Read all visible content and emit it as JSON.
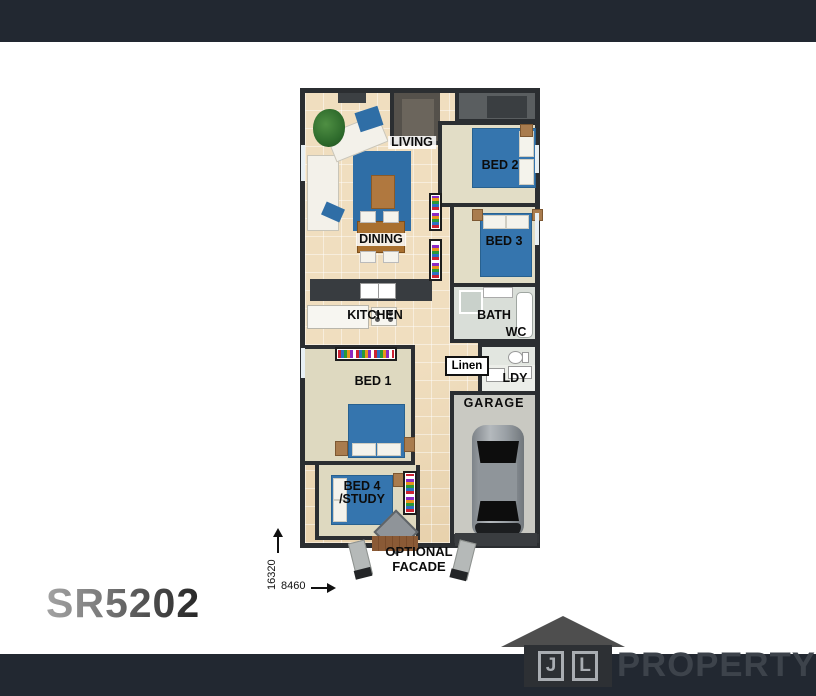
{
  "title": {
    "plan_code": "SR5202"
  },
  "plan": {
    "labels": {
      "living": "LIVING",
      "bed2": "BED 2",
      "bed3": "BED 3",
      "dining": "DINING",
      "kitchen": "KITCHEN",
      "bath": "BATH",
      "wc": "WC",
      "linen": "Linen",
      "ldy": "LDY",
      "bed1": "BED 1",
      "garage": "GARAGE",
      "bed4_line1": "BED 4",
      "bed4_line2": "/STUDY",
      "facade_line1": "OPTIONAL",
      "facade_line2": "FACADE"
    },
    "dimensions": {
      "vertical": "16320",
      "horizontal": "8460"
    }
  },
  "logo": {
    "initial_j": "J",
    "initial_l": "L",
    "name": "PROPERTY"
  },
  "colors": {
    "header_footer_bar": "#222831",
    "wall": "#2b2e31",
    "tile_floor": "#ebd7b6",
    "carpet_floor": "#e2ddc6",
    "bed_blue": "#3575ae",
    "rug_blue": "#2f6ea6",
    "garage_floor": "#c9c9c2",
    "logo_gray": "#4e4e4e",
    "logo_text": "#3d434b"
  }
}
